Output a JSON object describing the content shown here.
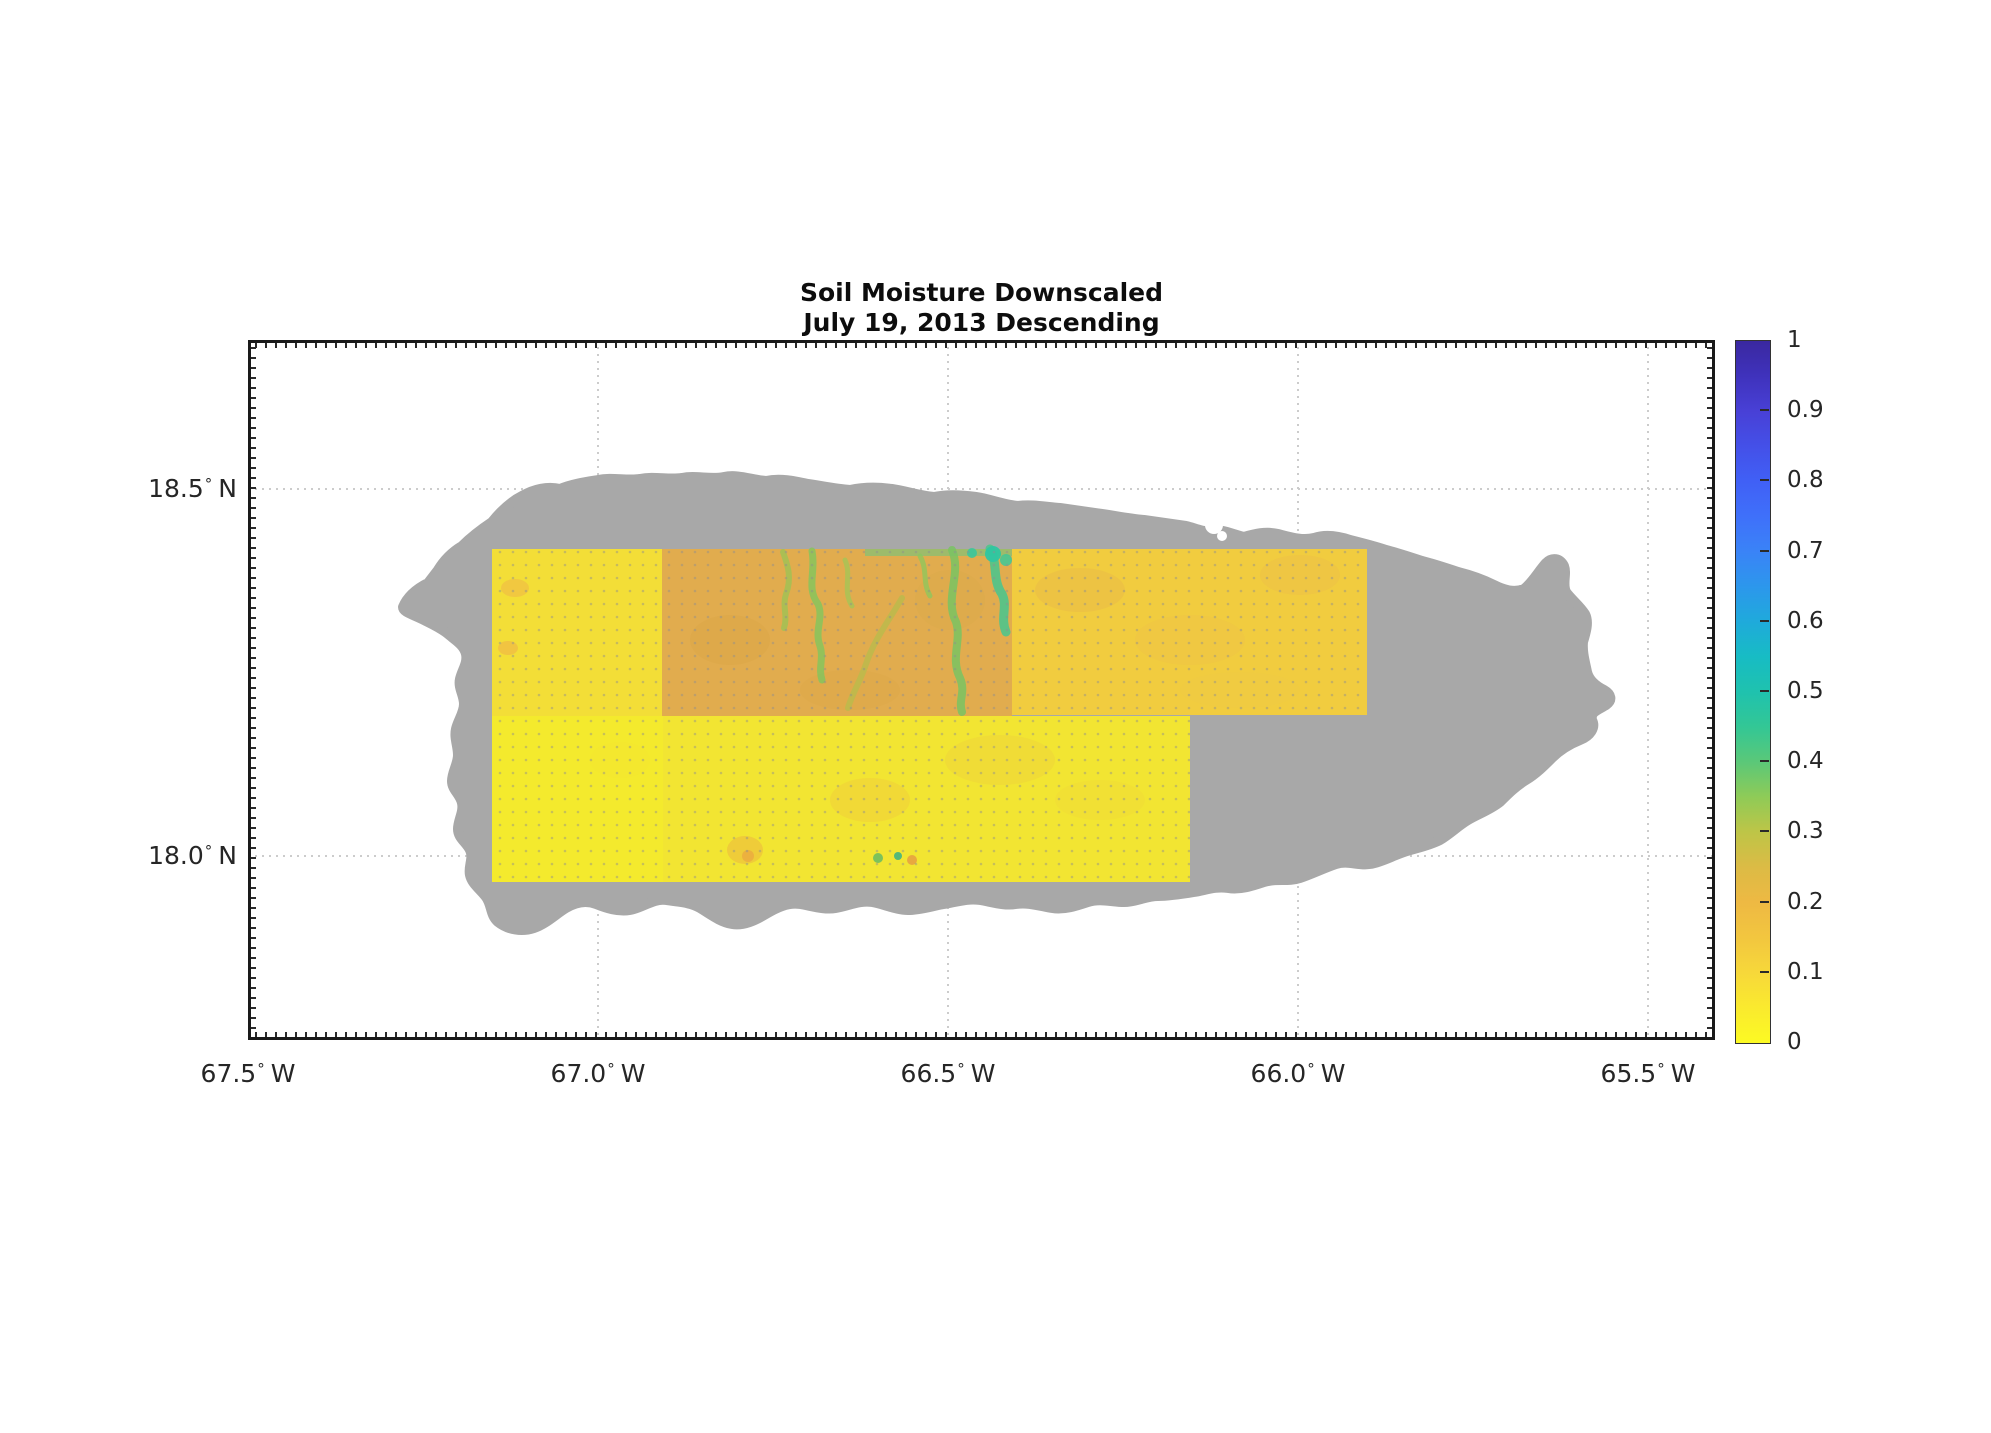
{
  "page": {
    "background": "#ffffff",
    "width": 1991,
    "height": 1433
  },
  "title": {
    "line1": "Soil Moisture Downscaled",
    "line2": "July 19, 2013 Descending"
  },
  "axes": {
    "degree_symbol": "°",
    "text_color": "#262626",
    "x_ticks": [
      {
        "num": "67.5",
        "hem": "W",
        "px": 248
      },
      {
        "num": "67.0",
        "hem": "W",
        "px": 598
      },
      {
        "num": "66.5",
        "hem": "W",
        "px": 948
      },
      {
        "num": "66.0",
        "hem": "W",
        "px": 1298
      },
      {
        "num": "65.5",
        "hem": "W",
        "px": 1648
      }
    ],
    "y_ticks": [
      {
        "num": "18.5",
        "hem": "N",
        "py": 489
      },
      {
        "num": "18.0",
        "hem": "N",
        "py": 856
      }
    ],
    "grid_x_px": [
      598,
      948,
      1298,
      1648
    ],
    "grid_y_px": [
      489,
      856
    ]
  },
  "colorbar": {
    "min": 0,
    "max": 1,
    "colormap": "parula reversed (0 = yellow, 1 = dark blue)",
    "ticks": [
      {
        "v": 1,
        "label": "1"
      },
      {
        "v": 0.9,
        "label": "0.9"
      },
      {
        "v": 0.8,
        "label": "0.8"
      },
      {
        "v": 0.7,
        "label": "0.7"
      },
      {
        "v": 0.6,
        "label": "0.6"
      },
      {
        "v": 0.5,
        "label": "0.5"
      },
      {
        "v": 0.4,
        "label": "0.4"
      },
      {
        "v": 0.3,
        "label": "0.3"
      },
      {
        "v": 0.2,
        "label": "0.2"
      },
      {
        "v": 0.1,
        "label": "0.1"
      },
      {
        "v": 0,
        "label": "0"
      }
    ],
    "stops": [
      {
        "p": 0,
        "c": "#FCFA23"
      },
      {
        "p": 5,
        "c": "#FAEA2E"
      },
      {
        "p": 10,
        "c": "#F7D83A"
      },
      {
        "p": 15,
        "c": "#F2C63F"
      },
      {
        "p": 20,
        "c": "#EEB943"
      },
      {
        "p": 25,
        "c": "#DCBB45"
      },
      {
        "p": 30,
        "c": "#BEC547"
      },
      {
        "p": 35,
        "c": "#8FCB57"
      },
      {
        "p": 40,
        "c": "#5BC878"
      },
      {
        "p": 45,
        "c": "#33C795"
      },
      {
        "p": 50,
        "c": "#1FC2AE"
      },
      {
        "p": 55,
        "c": "#17BCC4"
      },
      {
        "p": 60,
        "c": "#1FAADB"
      },
      {
        "p": 65,
        "c": "#2C97EC"
      },
      {
        "p": 70,
        "c": "#3A83F7"
      },
      {
        "p": 75,
        "c": "#3F70FA"
      },
      {
        "p": 80,
        "c": "#4060F6"
      },
      {
        "p": 85,
        "c": "#4450E8"
      },
      {
        "p": 90,
        "c": "#4840D6"
      },
      {
        "p": 95,
        "c": "#3F32BC"
      },
      {
        "p": 100,
        "c": "#3A28A0"
      }
    ]
  },
  "chart_data": {
    "type": "heatmap",
    "title": "Soil Moisture Downscaled",
    "subtitle": "July 19, 2013 Descending",
    "region": "Puerto Rico",
    "x_axis": {
      "label": "longitude",
      "ticks": [
        "67.5° W",
        "67.0° W",
        "66.5° W",
        "66.0° W",
        "65.5° W"
      ],
      "range": [
        "67.5° W",
        "65.4° W"
      ]
    },
    "y_axis": {
      "label": "latitude",
      "ticks": [
        "18.5° N",
        "18.0° N"
      ],
      "range": [
        "17.75° N",
        "18.70° N"
      ]
    },
    "grid": "dotted, at labeled ticks",
    "legend_position": "right colorbar",
    "colorbar_range": [
      0,
      1
    ],
    "colorbar_ticks": [
      0,
      0.1,
      0.2,
      0.3,
      0.4,
      0.5,
      0.6,
      0.7,
      0.8,
      0.9,
      1
    ],
    "no_data_color": "#A8A8A8",
    "no_data_meaning": "gray island landmask without retrieval",
    "tiles": [
      {
        "name": "northwest-tile",
        "lon_extent": "67.15W to 66.91W",
        "lat_extent": "18.19N to 18.42N",
        "approx_soil_moisture": 0.07,
        "fill": "#F3DE37",
        "px": {
          "x": 492,
          "y": 549,
          "w": 170,
          "h": 167
        }
      },
      {
        "name": "north-central-tile",
        "lon_extent": "66.91W to 66.41W",
        "lat_extent": "18.19N to 18.42N",
        "approx_soil_moisture": 0.2,
        "note": "green stream networks ~0.3-0.45",
        "fill": "#E1AC4E",
        "px": {
          "x": 662,
          "y": 549,
          "w": 350,
          "h": 167
        }
      },
      {
        "name": "northeast-tile",
        "lon_extent": "66.41W to 65.90W",
        "lat_extent": "18.20N to 18.42N",
        "approx_soil_moisture": 0.12,
        "fill": "#F1CC3F",
        "px": {
          "x": 1012,
          "y": 549,
          "w": 355,
          "h": 166
        }
      },
      {
        "name": "southwest-tile",
        "lon_extent": "67.15W to 66.91W",
        "lat_extent": "17.97N to 18.19N",
        "approx_soil_moisture": 0.05,
        "fill": "#F4EA2D",
        "px": {
          "x": 492,
          "y": 716,
          "w": 171,
          "h": 166
        }
      },
      {
        "name": "south-central-tile",
        "lon_extent": "66.91W to 66.15W",
        "lat_extent": "17.97N to 18.19N",
        "approx_soil_moisture": 0.06,
        "fill": "#F2E532",
        "px": {
          "x": 663,
          "y": 716,
          "w": 527,
          "h": 166
        }
      }
    ]
  }
}
